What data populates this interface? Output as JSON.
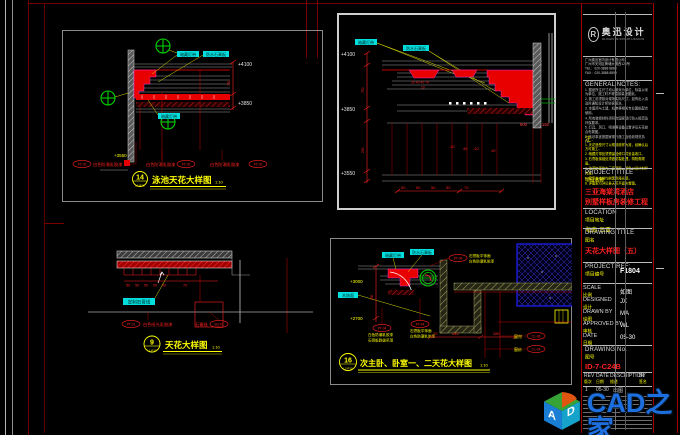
{
  "watermark": {
    "brand": "CAD之家",
    "site": "WWW.CADZJ.COM",
    "cube_a": "A",
    "cube_d": "D"
  },
  "p14": {
    "num": "14",
    "ref": "L1-P10",
    "title": "泳池天花大样图",
    "scale": "1:10",
    "label_lamp": "暗藏灯带",
    "label_board": "防水石膏板",
    "label_lamp2": "暗藏灯带",
    "elev_top": "+4100",
    "elev_mid": "+3850",
    "elev_bot": "+3550",
    "dim_750": "750",
    "finish1_tag": "PT-02",
    "finish1_text": "白色防潮乳胶漆",
    "finish2_text": "白色防潮乳胶漆",
    "finish2_tag": "PT-02",
    "finish3_text": "白色防潮乳胶漆",
    "finish3_tag": "PT-02"
  },
  "ptr": {
    "label_lamp": "暗藏灯带",
    "label_board": "防水石膏板",
    "elev_top": "+4100",
    "elev_mid": "+3850",
    "elev_bot": "+3550",
    "dim_left1": "750",
    "dim_left2": "250",
    "dim_c1": "20 40 40 70",
    "dim_c2": "10",
    "dim_600": "600",
    "dim_150": "150",
    "dim_n1": "-10",
    "dim_n2": "40",
    "dim_n3": "-10",
    "dim_n4": "±0",
    "dim_b1": "50",
    "dim_b2": "50",
    "dim_b3": "50",
    "dim_b4": "50",
    "dim_b5": "70"
  },
  "p9": {
    "num": "9",
    "ref": "L1-P10",
    "title": "天花大样图",
    "scale": "1:10",
    "label_gypsum": "定制石膏线",
    "dim_1": "50",
    "dim_2": "50",
    "dim_3": "50",
    "dim_4": "50",
    "dim_5": "50",
    "dim_6": "70",
    "finish1_tag": "PT-01",
    "finish1_text": "白色哑光乳胶漆",
    "finish2_text": "石膏线",
    "finish2_tag": "SG-01"
  },
  "p16": {
    "num": "16",
    "ref": "L2-P10",
    "title": "次主卧、卧室一、二天花大样图",
    "scale": "1:10",
    "label_lamp": "暗藏灯带",
    "label_board": "防水石膏板",
    "label_wood": "木饰面",
    "elev_top": "+3000",
    "elev_bot": "+2700",
    "dim_side": "300",
    "top_tag": "PT-04",
    "top_line1": "石膏板平饰面",
    "top_line2": "白色防潮乳胶漆",
    "g1_tag": "PT-04",
    "g1_line1": "白色防潮乳胶漆",
    "g1_line2": "石膏板跌级吊顶",
    "g2_tag": "PT-04",
    "g2_line1": "石膏板平饰面",
    "g2_line2": "白色防潮乳胶漆",
    "dim_70": "70",
    "dim_440": "440",
    "dim_280": "280",
    "curtain1_label": "窗帘",
    "curtain1_tag": "CL-06",
    "curtain2_label": "窗纱",
    "curtain2_tag": "CL-04"
  },
  "tb": {
    "company_cn": "奥迅设计",
    "company_en": "AOXUN INTERIOR DESIGN",
    "logo_letter": "R",
    "address": [
      "广州奥迅室内设计有限公司",
      "广州市天河区黄埔大道西120号",
      "TEL：020-3888 8888",
      "FAX：020-3888 8899"
    ],
    "gn_heading": "GENERAL NOTES:",
    "gn": [
      "1. 图纸所注尺寸均以毫米为单位，标高以米为单位，施工时不得直接量度图纸。",
      "2. 施工前须核对现场实际尺寸，如有出入请及时通知设计师协调解决。",
      "3. 本图须与土建、机电等相关专业图纸配合使用。",
      "4. 所有装修材料须符合国家现行防火规范及环保要求。",
      "5. 灯具、风口、喷淋等设备位置详见天花综合布置图。",
      "6. 未尽事宜按国家现行施工及验收规范执行。"
    ],
    "zh_heading": "注:",
    "zh": [
      "1. 天花造型尺寸以现场放样为准，经确认后方可施工。",
      "2. 暗藏灯带处须预留检修口并妥善收口。",
      "3. 石膏板接缝处须做防裂处理，阴阳角顺直。",
      "4. 油漆饰面均为三底两面，颜色以设计封样为准。",
      "5. 窗帘盒内侧均刷黑色哑光漆。",
      "6. 详图索引详见各天花平面布置图。"
    ],
    "pt_en": "PROJECT TITLE",
    "pt_cn": "项目名称",
    "pt_line1": "三亚海棠湾酒店",
    "pt_line2": "别墅样板房装修工程",
    "loc_en": "LOCATION",
    "loc_cn": "项目地址",
    "loc_value": "海南·三亚",
    "dt_en": "DRAWING TITLE",
    "dt_cn": "图名",
    "dt_value": "天花大样图（五）",
    "ref_en": "PROJECT REF:",
    "ref_cn": "项目编号",
    "ref_value": "F1804",
    "rows": [
      {
        "en": "SCALE",
        "cn": "比例",
        "val": "如图"
      },
      {
        "en": "DESIGNED",
        "cn": "设计",
        "val": "JX"
      },
      {
        "en": "DRAWN BY",
        "cn": "绘图",
        "val": "MA"
      },
      {
        "en": "APPROVED BY",
        "cn": "审核",
        "val": "WL"
      },
      {
        "en": "DATE",
        "cn": "日期",
        "val": "05-30"
      }
    ],
    "no_en": "DRAWING No.",
    "no_cn": "图号",
    "no_value": "ID-7-C24B",
    "rev": {
      "h1_en": "REV",
      "h1_cn": "版次",
      "h2_en": "DATE",
      "h2_cn": "日期",
      "h3_en": "DESCRIPTION",
      "h3_cn": "描述",
      "h4_en": "BY",
      "h4_cn": "签名",
      "r1": "1",
      "r1_date": "05-30",
      "r1_desc": "出图"
    }
  }
}
